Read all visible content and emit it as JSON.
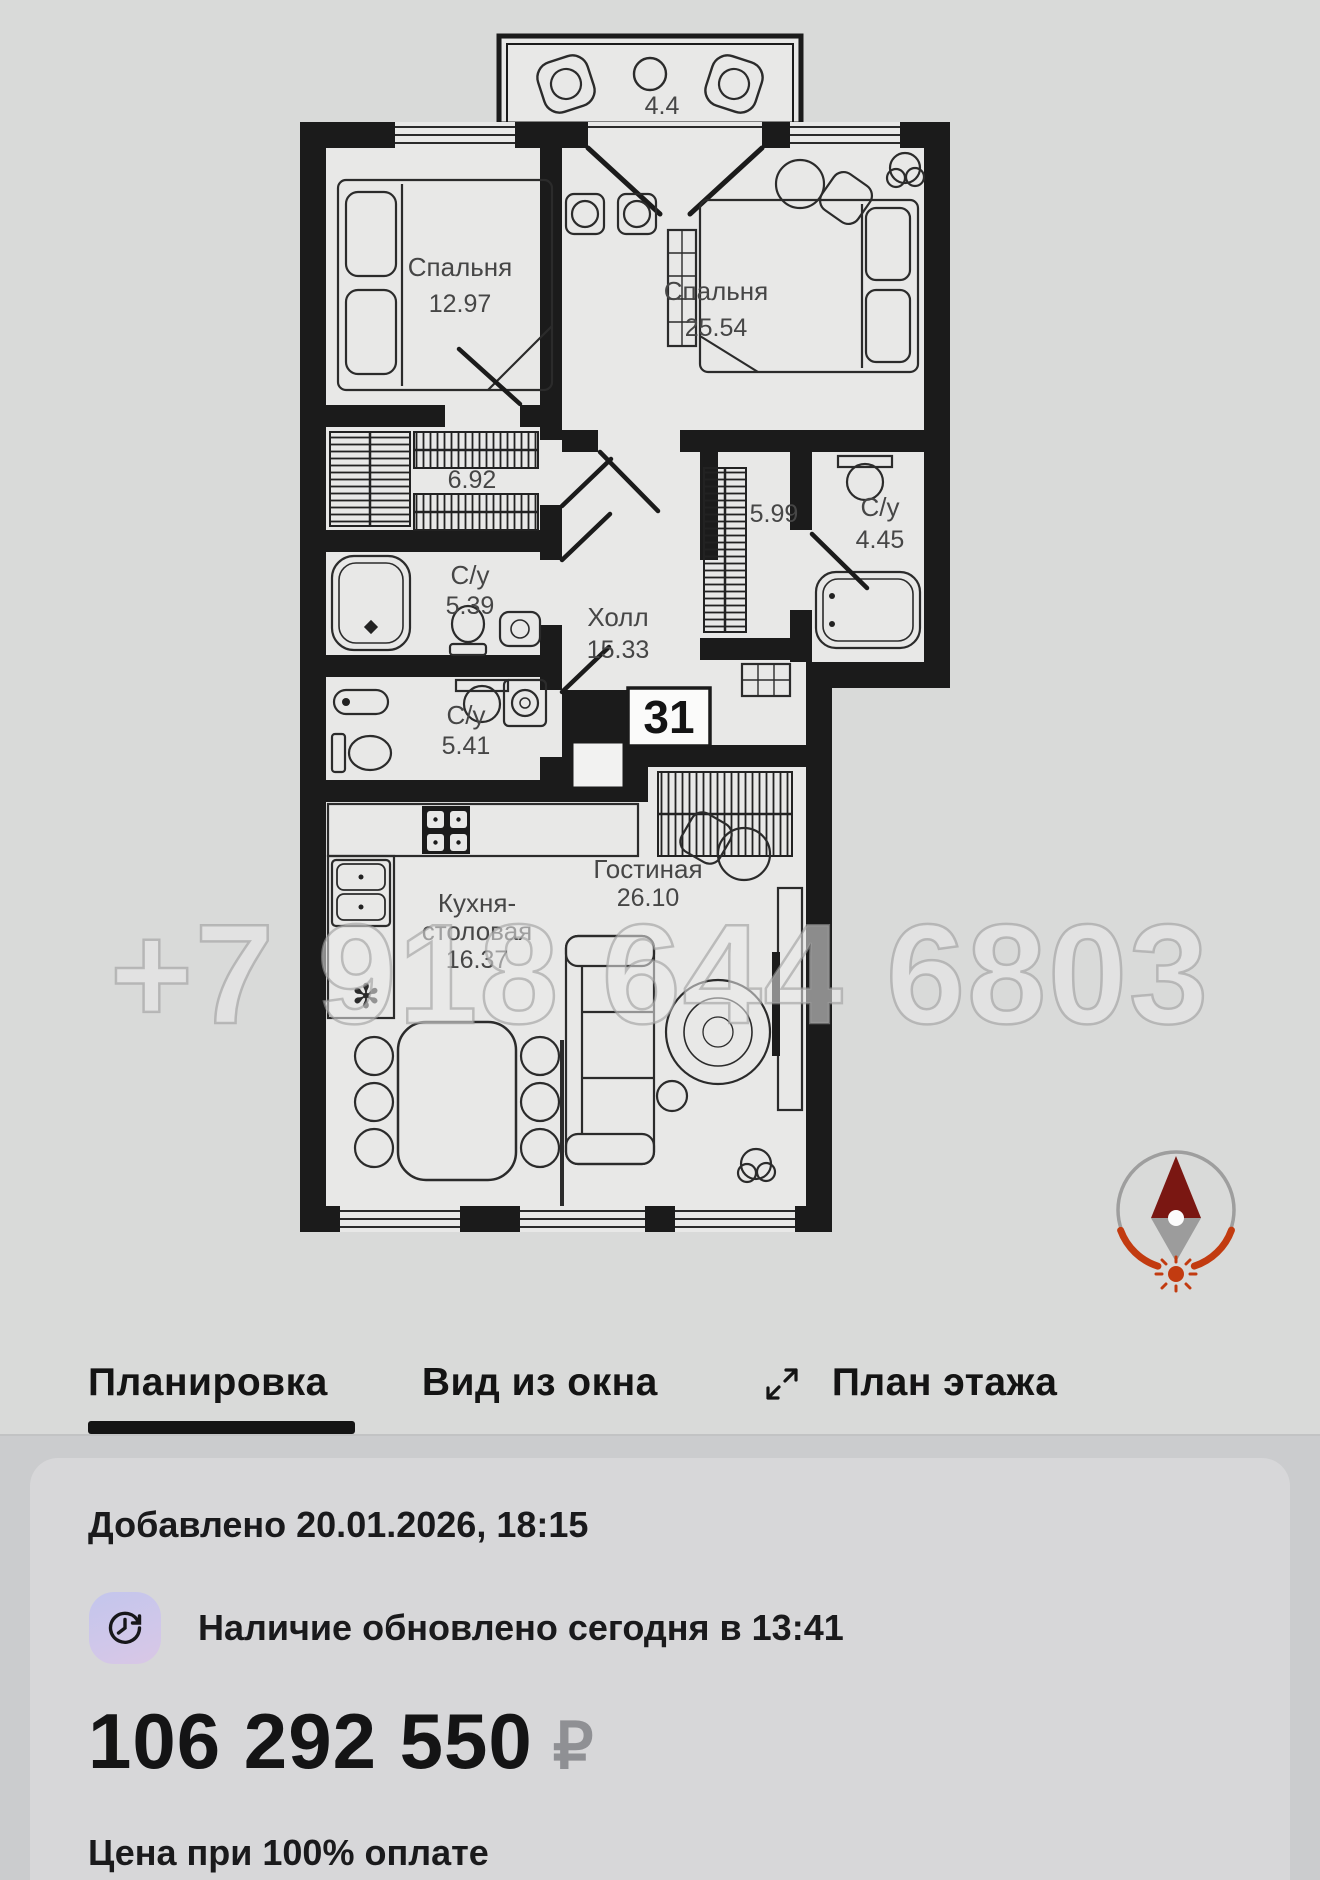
{
  "floorplan": {
    "apartment_number": "31",
    "watermark": "+7 918 644 6803",
    "rooms": {
      "bedroom_small": {
        "name": "Спальня",
        "area": "12.97"
      },
      "bedroom_large": {
        "name": "Спальня",
        "area": "25.54"
      },
      "wardrobe": {
        "area": "6.92"
      },
      "bathroom_1": {
        "name": "С/у",
        "area": "5.39"
      },
      "bathroom_2": {
        "name": "С/у",
        "area": "5.41"
      },
      "bathroom_3": {
        "name": "С/у",
        "area": "4.45"
      },
      "hallway": {
        "name": "Холл",
        "area": "15.33"
      },
      "corridor": {
        "area": "5.99"
      },
      "kitchen": {
        "name_line_1": "Кухня-",
        "name_line_2": "столовая",
        "area": "16.37"
      },
      "living_room": {
        "name": "Гостиная",
        "area": "26.10"
      },
      "balcony": {
        "area": "4.4"
      }
    },
    "icons": {
      "compass": "compass-north-arrow-with-sun"
    }
  },
  "tabs": {
    "active_label": "Планировка",
    "items": [
      {
        "label": "Планировка"
      },
      {
        "label": "Вид из окна"
      },
      {
        "label": "План этажа"
      }
    ],
    "expand_icon": "expand-diagonal-arrows"
  },
  "card": {
    "added_line": "Добавлено 20.01.2026, 18:15",
    "availability_line": "Наличие обновлено сегодня в 13:41",
    "availability_icon": "clock-refresh",
    "price": "106 292 550",
    "currency_symbol": "₽",
    "price_caption": "Цена при 100% оплате"
  },
  "colors": {
    "compass_red": "#c23b10",
    "compass_needle_dark": "#7a1712",
    "icon_gradient_start": "#c3c6ec",
    "icon_gradient_end": "#d9c7e5",
    "tab_active_underline": "#141414",
    "currency_gray": "#8f9094"
  }
}
